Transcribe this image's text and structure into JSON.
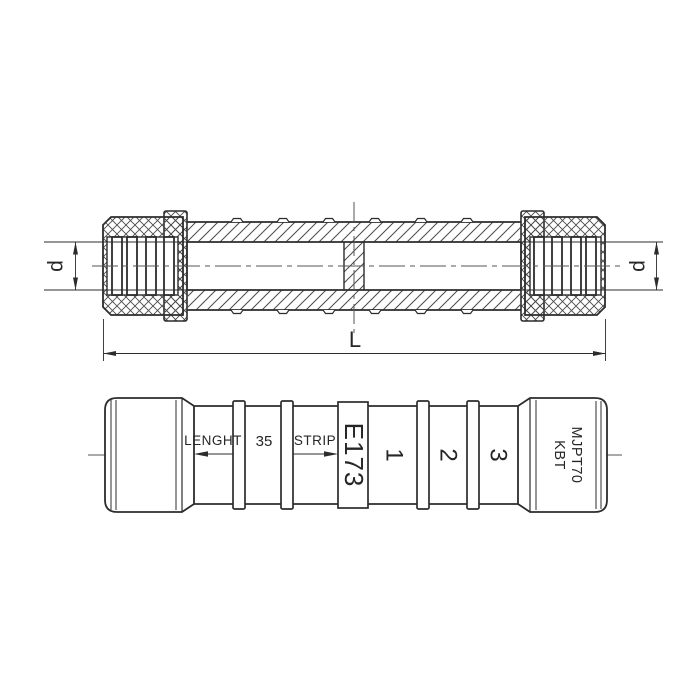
{
  "drawing": {
    "kind": "connector-technical-drawing",
    "section_view": {
      "diameter_label_left": "d",
      "diameter_label_right": "d",
      "length_label": "L"
    },
    "side_view": {
      "length_text": "LENGHT",
      "strip_length": "35",
      "strip_text": "STRIP",
      "product_code": "E173",
      "section_marks": [
        "1",
        "2",
        "3"
      ],
      "brand": "KBT",
      "model": "MJPT70"
    },
    "colors": {
      "line": "#2c2c2c",
      "hatch": "#4a4a4a",
      "centerline": "#555555",
      "background": "#ffffff"
    }
  }
}
